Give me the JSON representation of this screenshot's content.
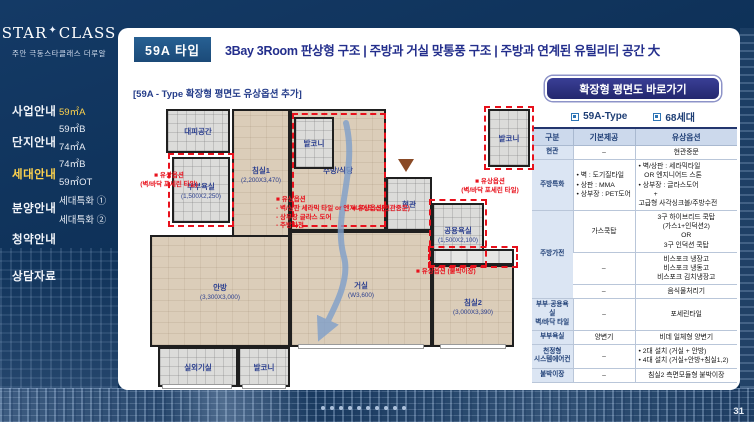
{
  "logo": {
    "brand_top": "STAR",
    "brand_star": "✦",
    "brand_bottom": "CLASS",
    "tagline": "주안 극동스타클래스 더루알"
  },
  "sidebar": {
    "main_menu": [
      {
        "label": "사업안내",
        "active": false
      },
      {
        "label": "단지안내",
        "active": false
      },
      {
        "label": "세대안내",
        "active": true
      },
      {
        "label": "분양안내",
        "active": false
      },
      {
        "label": "청약안내",
        "active": false
      },
      {
        "label": "상담자료",
        "active": false
      }
    ],
    "sub_menu": [
      {
        "label": "59㎡A",
        "active": true
      },
      {
        "label": "59㎡B",
        "active": false
      },
      {
        "label": "74㎡A",
        "active": false
      },
      {
        "label": "74㎡B",
        "active": false
      },
      {
        "label": "59㎡OT",
        "active": false
      },
      {
        "label": "세대특화 ①",
        "active": false
      },
      {
        "label": "세대특화 ②",
        "active": false
      }
    ]
  },
  "header": {
    "badge": "59A 타입",
    "title": "3Bay 3Room 판상형 구조 | 주방과 거실 맞통풍 구조 | 주방과 연계된 유틸리티 공간 大"
  },
  "plan": {
    "caption": "[59A - Type 확장형 평면도 유상옵션 추가]",
    "rooms": [
      {
        "key": "refuge",
        "kind": "tile",
        "name": "대피공간",
        "dim": ""
      },
      {
        "key": "bathmaster",
        "kind": "tile",
        "name": "부부욕실",
        "dim": "(1,500X2,250)"
      },
      {
        "key": "bed1",
        "kind": "wood",
        "name": "침실1",
        "dim": "(2,200X3,470)"
      },
      {
        "key": "kitchen",
        "kind": "wood",
        "name": "주방/식당",
        "dim": ""
      },
      {
        "key": "baltop",
        "kind": "tile",
        "name": "발코니",
        "dim": ""
      },
      {
        "key": "entry",
        "kind": "tile",
        "name": "현관",
        "dim": ""
      },
      {
        "key": "bathcommon",
        "kind": "tile",
        "name": "공용욕실",
        "dim": "(1,500X2,100)"
      },
      {
        "key": "balright",
        "kind": "tile",
        "name": "발코니",
        "dim": ""
      },
      {
        "key": "master",
        "kind": "wood",
        "name": "안방",
        "dim": "(3,300X3,000)"
      },
      {
        "key": "living",
        "kind": "wood",
        "name": "거실",
        "dim": "(W3,600)"
      },
      {
        "key": "bed2",
        "kind": "wood",
        "name": "침실2",
        "dim": "(3,000X3,390)"
      },
      {
        "key": "outdoor",
        "kind": "tile",
        "name": "실외기실",
        "dim": ""
      },
      {
        "key": "balbottom",
        "kind": "tile",
        "name": "발코니",
        "dim": ""
      }
    ],
    "annotations": [
      {
        "key": "masterbath",
        "text": "■ 유상옵션\n(벽/바닥 포세린 타일)"
      },
      {
        "key": "kitchen",
        "text": "■ 유상옵션\n- 벽/상판 세라믹 타일 or 엔지니어드 스톤\n- 상부장 글라스 도어\n- 주방가전"
      },
      {
        "key": "entrance",
        "text": "■ 유상옵션(현관중문)"
      },
      {
        "key": "commonbath",
        "text": "■ 유상옵션\n(벽/바닥 포세린 타일)"
      },
      {
        "key": "closet",
        "text": "■ 유상옵션 (붙박이장)"
      }
    ]
  },
  "panel": {
    "cta": "확장형 평면도 바로가기",
    "tabs": [
      "59A-Type",
      "68세대"
    ],
    "table": {
      "headers": [
        "구분",
        "기본제공",
        "유상옵션"
      ],
      "rows": [
        {
          "cat": "현관",
          "rowspan": 1,
          "basic": "–",
          "option": "현관중문"
        },
        {
          "cat": "주방특화",
          "rowspan": 1,
          "basic": "• 벽 : 도기질타일\n• 상판 : MMA\n• 상부장 : PET도어",
          "option": "• 벽/상판 : 세라믹타일\n   OR 엔지니어드 스톤\n• 상부장 : 글라스도어\n        +\n고급형 사각싱크볼/주방수전"
        },
        {
          "cat": "주방가전",
          "rowspan": 3,
          "basic": "가스쿡탑",
          "option": "3구 하이브리드 쿡탑\n(가스1+인덕션2)\nOR\n3구 인덕션 쿡탑"
        },
        {
          "cat": null,
          "basic": "–",
          "option": "비스포크 냉장고\n비스포크 냉동고\n비스포크 김치냉장고"
        },
        {
          "cat": null,
          "basic": "–",
          "option": "음식물처리기"
        },
        {
          "cat": "부부·공용욕실\n벽/바닥 타일",
          "rowspan": 1,
          "basic": "–",
          "option": "포세린타일"
        },
        {
          "cat": "부부욕실",
          "rowspan": 1,
          "basic": "양변기",
          "option": "비데 일체형 양변기"
        },
        {
          "cat": "천정형\n시스템에어컨",
          "rowspan": 1,
          "basic": "–",
          "option": "• 2대 설치 (거실 + 안방)\n• 4대 설치 (거실+안방+침실1,2)"
        },
        {
          "cat": "붙박이장",
          "rowspan": 1,
          "basic": "–",
          "option": "침실2 측면모듈형 붙박이장"
        }
      ]
    }
  },
  "footer": {
    "page_number": "31",
    "dots": 10
  }
}
